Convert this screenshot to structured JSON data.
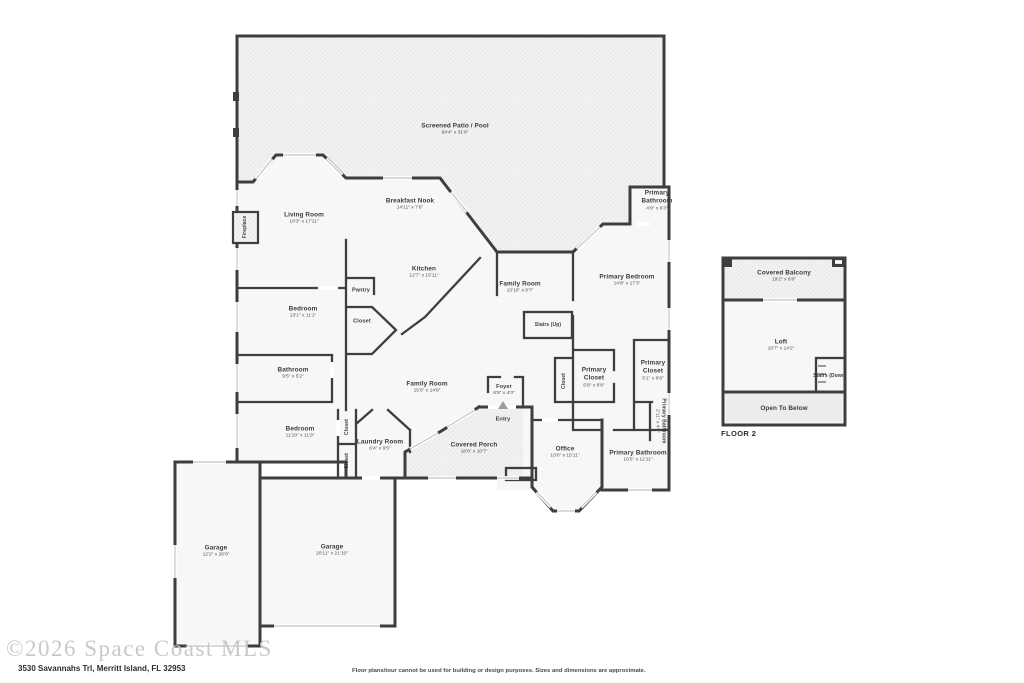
{
  "page": {
    "watermark": "©2026 Space Coast MLS",
    "address": "3530 Savannahs Trl, Merritt Island, FL 32953",
    "disclaimer": "Floor plans/tour cannot be used for building or design purposes. Sizes and dimensions are approximate.",
    "floor2_label": "FLOOR 2"
  },
  "colors": {
    "walls": "#3e3e3e",
    "room_fill": "#f7f7f7",
    "patio_fill": "#f1f1f1",
    "watermark_text": "#c9c9c9"
  },
  "floor1": {
    "screened_patio": {
      "name": "Screened Patio / Pool",
      "dims": "64'4\" x 31'6\""
    },
    "living_room": {
      "name": "Living Room",
      "dims": "18'3\" x 17'11\""
    },
    "breakfast_nook": {
      "name": "Breakfast Nook",
      "dims": "14'11\" x 7'6\""
    },
    "kitchen": {
      "name": "Kitchen",
      "dims": "12'7\" x 15'11\""
    },
    "primary_bathroom_top": {
      "name": "Primary Bathroom",
      "dims": "4'9\" x 6'3\""
    },
    "family_room_upper": {
      "name": "Family Room",
      "dims": "13'10\" x 8'7\""
    },
    "primary_bedroom": {
      "name": "Primary Bedroom",
      "dims": "14'8\" x 17'3\""
    },
    "stairs_up": {
      "name": "Stairs (Up)"
    },
    "pantry": {
      "name": "Pantry"
    },
    "bedroom1": {
      "name": "Bedroom",
      "dims": "13'1\" x 11'1\""
    },
    "closet_bedroom1": {
      "name": "Closet"
    },
    "bathroom": {
      "name": "Bathroom",
      "dims": "9'5\" x 5'2\""
    },
    "bedroom2": {
      "name": "Bedroom",
      "dims": "11'10\" x 11'9\""
    },
    "closet_a": {
      "name": "Closet"
    },
    "closet_b": {
      "name": "Closet"
    },
    "laundry": {
      "name": "Laundry Room",
      "dims": "6'4\" x 9'5\""
    },
    "family_room_center": {
      "name": "Family Room",
      "dims": "15'6\" x 14'9\""
    },
    "foyer": {
      "name": "Foyer",
      "dims": "6'5\" x 4'0\""
    },
    "entry": {
      "name": "Entry"
    },
    "covered_porch": {
      "name": "Covered Porch",
      "dims": "18'6\" x 10'7\""
    },
    "office": {
      "name": "Office",
      "dims": "10'0\" x 15'11\""
    },
    "closet_hall": {
      "name": "Closet"
    },
    "primary_closet_left": {
      "name": "Primary Closet",
      "dims": "5'8\" x 8'8\""
    },
    "primary_closet_right": {
      "name": "Primary Closet",
      "dims": "5'1\" x 8'8\""
    },
    "primary_bathroom_small": {
      "name": "Primary Bathroom",
      "dims": "2'11\" x 4'0\""
    },
    "primary_bathroom_main": {
      "name": "Primary Bathroom",
      "dims": "16'5\" x 12'11\""
    },
    "garage_left": {
      "name": "Garage",
      "dims": "12'2\" x 26'0\""
    },
    "garage_right": {
      "name": "Garage",
      "dims": "20'11\" x 21'10\""
    },
    "fireplace": {
      "name": "Fireplace"
    }
  },
  "floor2": {
    "covered_balcony": {
      "name": "Covered Balcony",
      "dims": "19'2\" x 6'0\""
    },
    "loft": {
      "name": "Loft",
      "dims": "18'7\" x 14'2\""
    },
    "stairs_down": {
      "name": "Stairs (Down)"
    },
    "open_to_below": {
      "name": "Open To Below"
    }
  }
}
